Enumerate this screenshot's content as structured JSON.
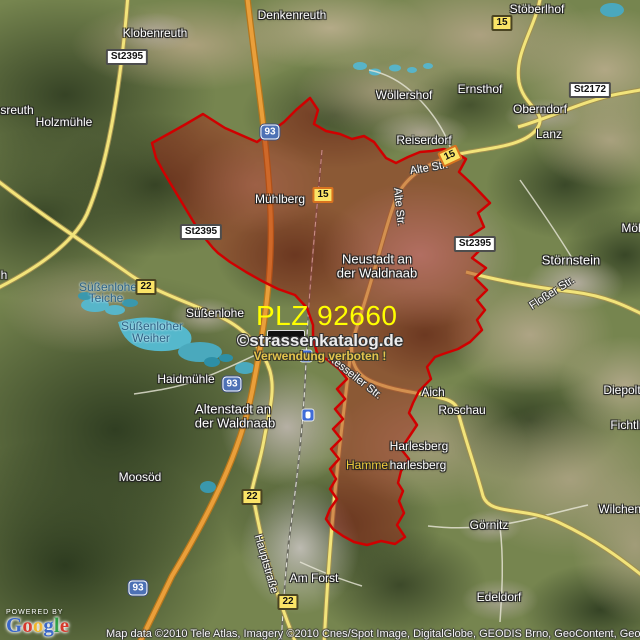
{
  "map": {
    "plz_label": "PLZ 92660",
    "watermark_line1": "©strassenkatalog.de",
    "watermark_line2": "Verwendung verboten !",
    "powered_by": "POWERED BY",
    "attribution": "Map data ©2010 Tele Atlas, Imagery ©2010 Cnes/Spot Image, DigitalGlobe, GEODIS Brno, GeoContent, GeoEye",
    "colors": {
      "plz_text": "#ffff00",
      "boundary_stroke": "#d00000",
      "boundary_fill": "rgba(170,28,18,0.42)",
      "motorway": "#ea9f3a",
      "main_road": "#f2e47a",
      "water": "#55b8cc",
      "shield_yellow": "#fbe467",
      "shield_blue": "#4d71b5"
    },
    "google_logo": {
      "letters": [
        {
          "ch": "G",
          "color": "#3a67c8"
        },
        {
          "ch": "o",
          "color": "#d6382c"
        },
        {
          "ch": "o",
          "color": "#efb52a"
        },
        {
          "ch": "g",
          "color": "#3a67c8"
        },
        {
          "ch": "l",
          "color": "#2f9e44"
        },
        {
          "ch": "e",
          "color": "#d6382c"
        }
      ]
    },
    "place_labels": [
      {
        "text": "Denkenreuth",
        "x": 292,
        "y": 15
      },
      {
        "text": "Klobenreuth",
        "x": 155,
        "y": 33
      },
      {
        "text": "Stöberlhof",
        "x": 537,
        "y": 9
      },
      {
        "text": "sreuth",
        "x": 17,
        "y": 110
      },
      {
        "text": "Holzmühle",
        "x": 64,
        "y": 122
      },
      {
        "text": "Wöllershof",
        "x": 404,
        "y": 95
      },
      {
        "text": "Ernsthof",
        "x": 480,
        "y": 89
      },
      {
        "text": "Oberndorf",
        "x": 540,
        "y": 109
      },
      {
        "text": "Lanz",
        "x": 549,
        "y": 134
      },
      {
        "text": "Reiserdorf",
        "x": 424,
        "y": 140
      },
      {
        "text": "Mühlberg",
        "x": 280,
        "y": 199
      },
      {
        "text": "Neustadt an",
        "x": 377,
        "y": 259,
        "big": true
      },
      {
        "text": "der Waldnaab",
        "x": 377,
        "y": 273,
        "big": true
      },
      {
        "text": "Störnstein",
        "x": 571,
        "y": 260,
        "big": true
      },
      {
        "text": "Möh",
        "x": 633,
        "y": 228
      },
      {
        "text": "h",
        "x": 4,
        "y": 275
      },
      {
        "text": "Süßenlohe",
        "x": 215,
        "y": 313
      },
      {
        "text": "Haidmühle",
        "x": 186,
        "y": 379
      },
      {
        "text": "Altenstadt an",
        "x": 233,
        "y": 409,
        "big": true
      },
      {
        "text": "der Waldnaab",
        "x": 235,
        "y": 423,
        "big": true
      },
      {
        "text": "Moosöd",
        "x": 140,
        "y": 477
      },
      {
        "text": "Aich",
        "x": 433,
        "y": 392
      },
      {
        "text": "Roschau",
        "x": 462,
        "y": 410
      },
      {
        "text": "Harlesberg",
        "x": 419,
        "y": 446
      },
      {
        "text": "Hammer",
        "x": 369,
        "y": 465,
        "yellow": true
      },
      {
        "text": "harlesberg",
        "x": 418,
        "y": 465
      },
      {
        "text": "Diepolts",
        "x": 625,
        "y": 390
      },
      {
        "text": "Fichtln",
        "x": 628,
        "y": 425
      },
      {
        "text": "Görnitz",
        "x": 489,
        "y": 525
      },
      {
        "text": "Wilchenre",
        "x": 625,
        "y": 509
      },
      {
        "text": "Am Forst",
        "x": 314,
        "y": 578
      },
      {
        "text": "Edeldorf",
        "x": 499,
        "y": 597
      }
    ],
    "water_labels": [
      {
        "text": "Süßenloher",
        "x": 110,
        "y": 287
      },
      {
        "text": "Teiche",
        "x": 106,
        "y": 298
      },
      {
        "text": "Süßenloher",
        "x": 152,
        "y": 326
      },
      {
        "text": "Weiher",
        "x": 151,
        "y": 338
      }
    ],
    "street_labels": [
      {
        "text": "Alte Str.",
        "x": 429,
        "y": 168,
        "rot": -10
      },
      {
        "text": "Alte Str.",
        "x": 399,
        "y": 207,
        "rot": 84
      },
      {
        "text": "Floßer Str.",
        "x": 552,
        "y": 293,
        "rot": -33
      },
      {
        "text": "Kesseiler Str.",
        "x": 355,
        "y": 377,
        "rot": 38
      },
      {
        "text": "Hauptstraße",
        "x": 266,
        "y": 564,
        "rot": 74
      }
    ],
    "road_shields": [
      {
        "text": "St2395",
        "type": "st",
        "x": 127,
        "y": 57
      },
      {
        "text": "15",
        "type": "y",
        "x": 502,
        "y": 23
      },
      {
        "text": "St2172",
        "type": "st",
        "x": 590,
        "y": 90
      },
      {
        "text": "93",
        "type": "b",
        "x": 270,
        "y": 132
      },
      {
        "text": "15",
        "type": "y hl",
        "x": 450,
        "y": 156,
        "rot": -25
      },
      {
        "text": "15",
        "type": "y hl",
        "x": 323,
        "y": 195
      },
      {
        "text": "St2395",
        "type": "st",
        "x": 201,
        "y": 232
      },
      {
        "text": "St2395",
        "type": "st",
        "x": 475,
        "y": 244
      },
      {
        "text": "22",
        "type": "y",
        "x": 146,
        "y": 287
      },
      {
        "text": "",
        "type": "dark",
        "x": 286,
        "y": 336
      },
      {
        "text": "93",
        "type": "b",
        "x": 232,
        "y": 384
      },
      {
        "text": "22",
        "type": "y",
        "x": 252,
        "y": 497
      },
      {
        "text": "93",
        "type": "b",
        "x": 138,
        "y": 588
      },
      {
        "text": "22",
        "type": "y",
        "x": 288,
        "y": 602
      }
    ],
    "station_icons": [
      {
        "x": 306,
        "y": 356
      },
      {
        "x": 308,
        "y": 415
      }
    ]
  }
}
